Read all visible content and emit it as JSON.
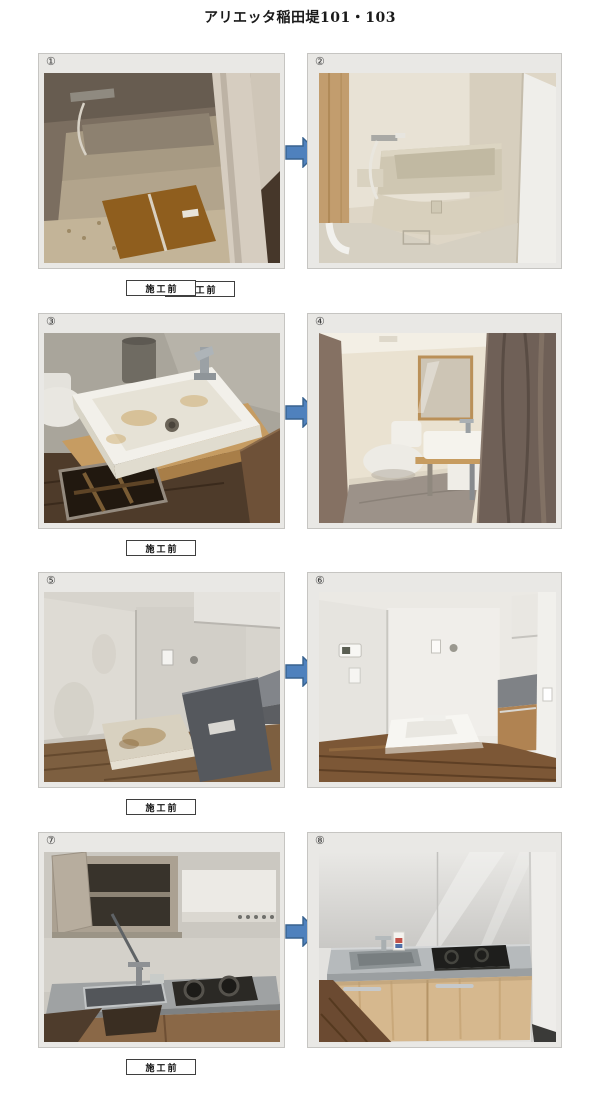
{
  "document": {
    "title": "アリエッタ稲田堤101・103"
  },
  "rows": [
    {
      "before": {
        "number": "①",
        "label": "施工前",
        "scene": "bathtub-dirty"
      },
      "after": {
        "number": "②",
        "label": "施工後",
        "scene": "bathtub-renovated"
      }
    },
    {
      "before": {
        "number": "③",
        "label": "施工前",
        "scene": "washbasin-dirty"
      },
      "after": {
        "number": "④",
        "label": "施工後",
        "scene": "washroom-renovated"
      }
    },
    {
      "before": {
        "number": "⑤",
        "label": "施工前",
        "scene": "laundry-corner-old"
      },
      "after": {
        "number": "⑥",
        "label": "施工後",
        "scene": "laundry-corner-renovated"
      }
    },
    {
      "before": {
        "number": "⑦",
        "label": "施工前",
        "scene": "kitchen-old"
      },
      "after": {
        "number": "⑧",
        "label": "施工後",
        "scene": "kitchen-renovated"
      }
    }
  ],
  "colors": {
    "arrow_fill": "#4f81bd",
    "arrow_stroke": "#38628f",
    "panel_bg": "#e9e8e5",
    "panel_border": "#c6c5c2",
    "label_border": "#3f3f3f"
  }
}
